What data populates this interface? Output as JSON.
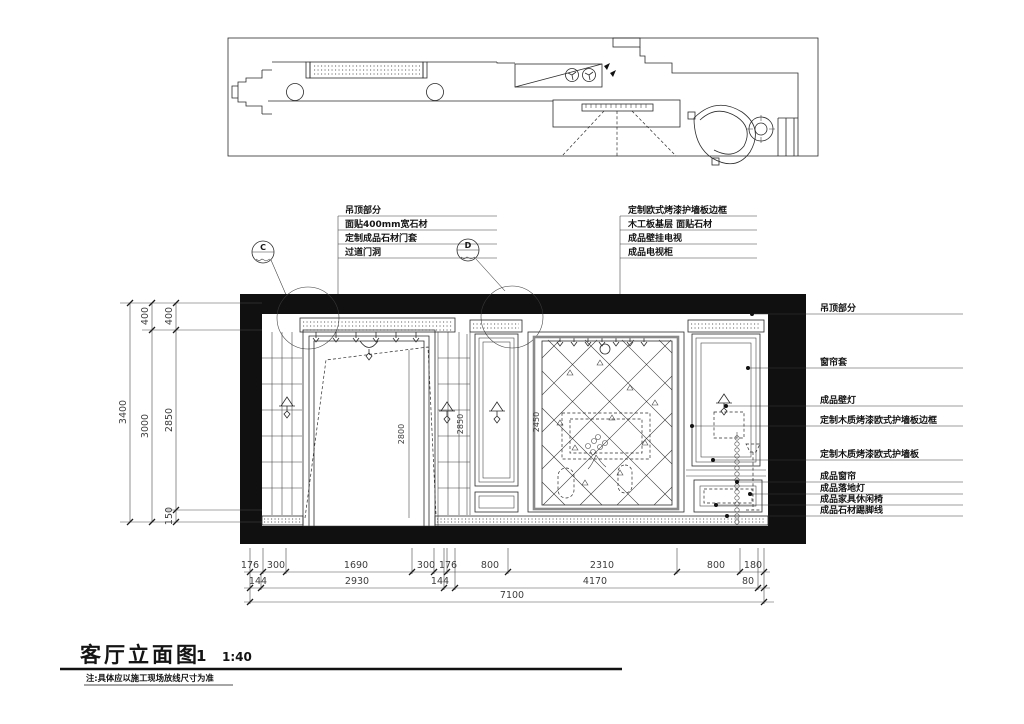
{
  "drawing": {
    "title": "客厅立面图",
    "sheet_number": "1",
    "scale": "1:40",
    "note": "注:具体应以施工现场放线尺寸为准"
  },
  "section_markers": {
    "c": "C",
    "d": "D"
  },
  "callouts": {
    "top_left": [
      "吊顶部分",
      "面贴400mm宽石材",
      "定制成品石材门套",
      "过道门洞"
    ],
    "top_right": [
      "定制欧式烤漆护墙板边框",
      "木工板基层 面贴石材",
      "成品壁挂电视",
      "成品电视柜"
    ],
    "right": [
      "吊顶部分",
      "窗帘套",
      "成品壁灯",
      "定制木质烤漆欧式护墙板边框",
      "定制木质烤漆欧式护墙板",
      "成品窗帘",
      "成品落地灯",
      "成品家具休闲椅",
      "成品石材踢脚线"
    ]
  },
  "dimensions": {
    "left_outer": "3400",
    "left_mid": [
      "400",
      "3000"
    ],
    "left_inner": [
      "400",
      "2850",
      "150"
    ],
    "bottom_row1": [
      "176",
      "300",
      "1690",
      "300",
      "176",
      "800",
      "2310",
      "800",
      "180"
    ],
    "bottom_row2": [
      "144",
      "2930",
      "144",
      "4170",
      "80"
    ],
    "bottom_total": "7100",
    "inner": {
      "door_height": "2800",
      "wall_height": "2850",
      "tv_wall": "2450"
    }
  },
  "colors": {
    "line": "#2b2b2b",
    "dim": "#4a4a4a",
    "background": "#ffffff"
  }
}
